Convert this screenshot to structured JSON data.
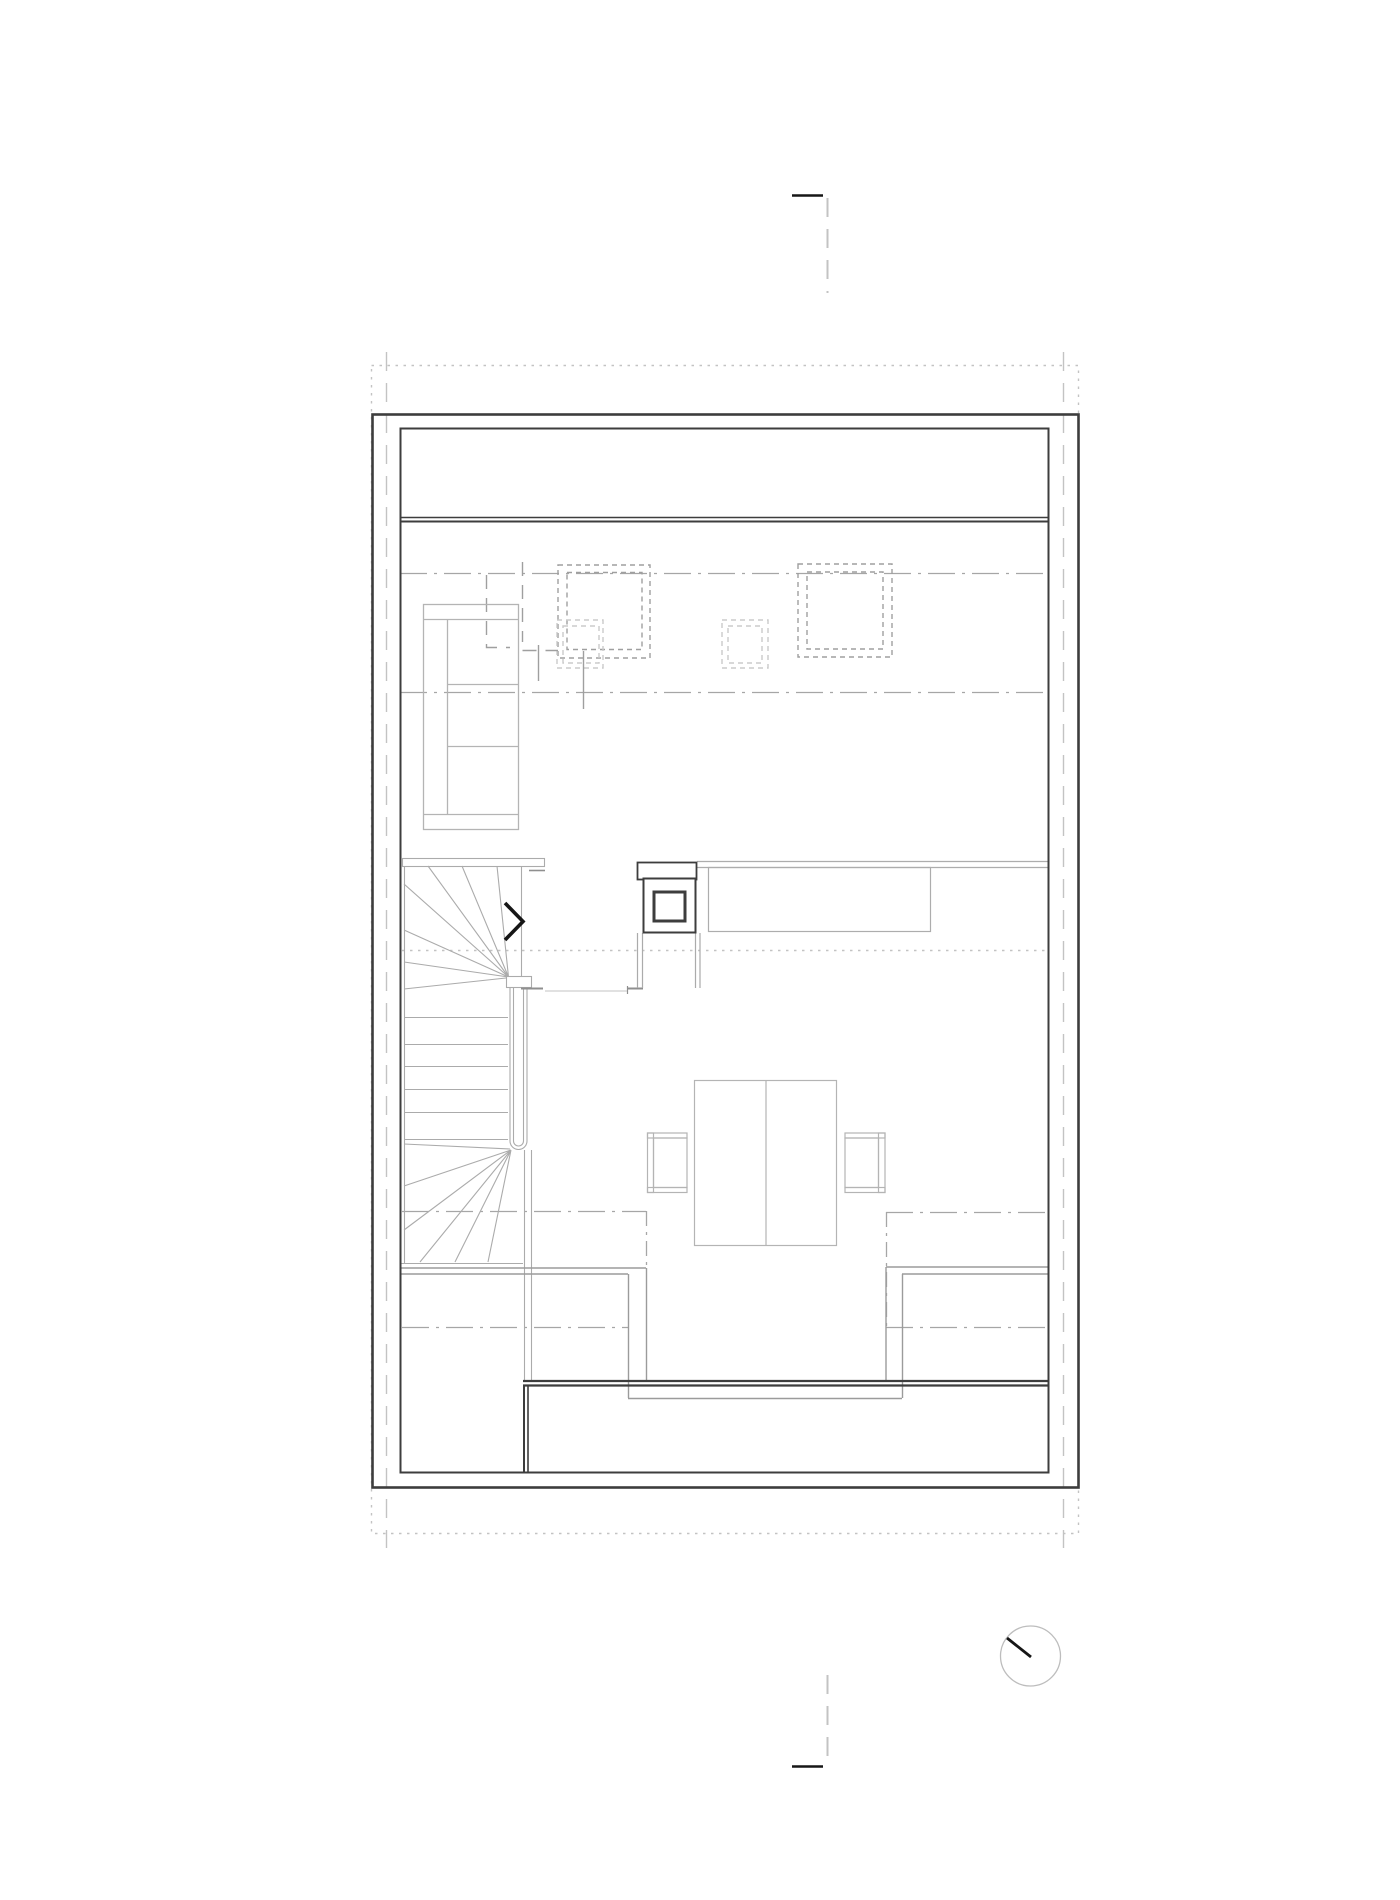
{
  "document": {
    "kind": "architectural-floor-plan",
    "level": "attic-floor",
    "background": "#ffffff",
    "text_labels": []
  },
  "colors": {
    "ink": "#161616",
    "wall": "#3d3d3d",
    "partition": "#9b9b9b",
    "stair": "#ababab",
    "fixture": "#b4b4b4",
    "counter": "#adadad",
    "guide": "#c3c3c3",
    "dashdot": "#a6a6a6",
    "skylight": "#9f9f9f",
    "skylight_light": "#cbcbcb",
    "stub": "#8f8f8f",
    "north_circle": "#bdbdbd"
  },
  "symbols": {
    "north_indicator": "circle-with-needle",
    "stair_direction": "chevron-right",
    "section_marks": [
      "top-center-tick",
      "bottom-center-tick"
    ]
  },
  "counts": {
    "skylights_large": 2,
    "skylights_small": 2,
    "straight_treads": 6,
    "chairs": 2
  }
}
